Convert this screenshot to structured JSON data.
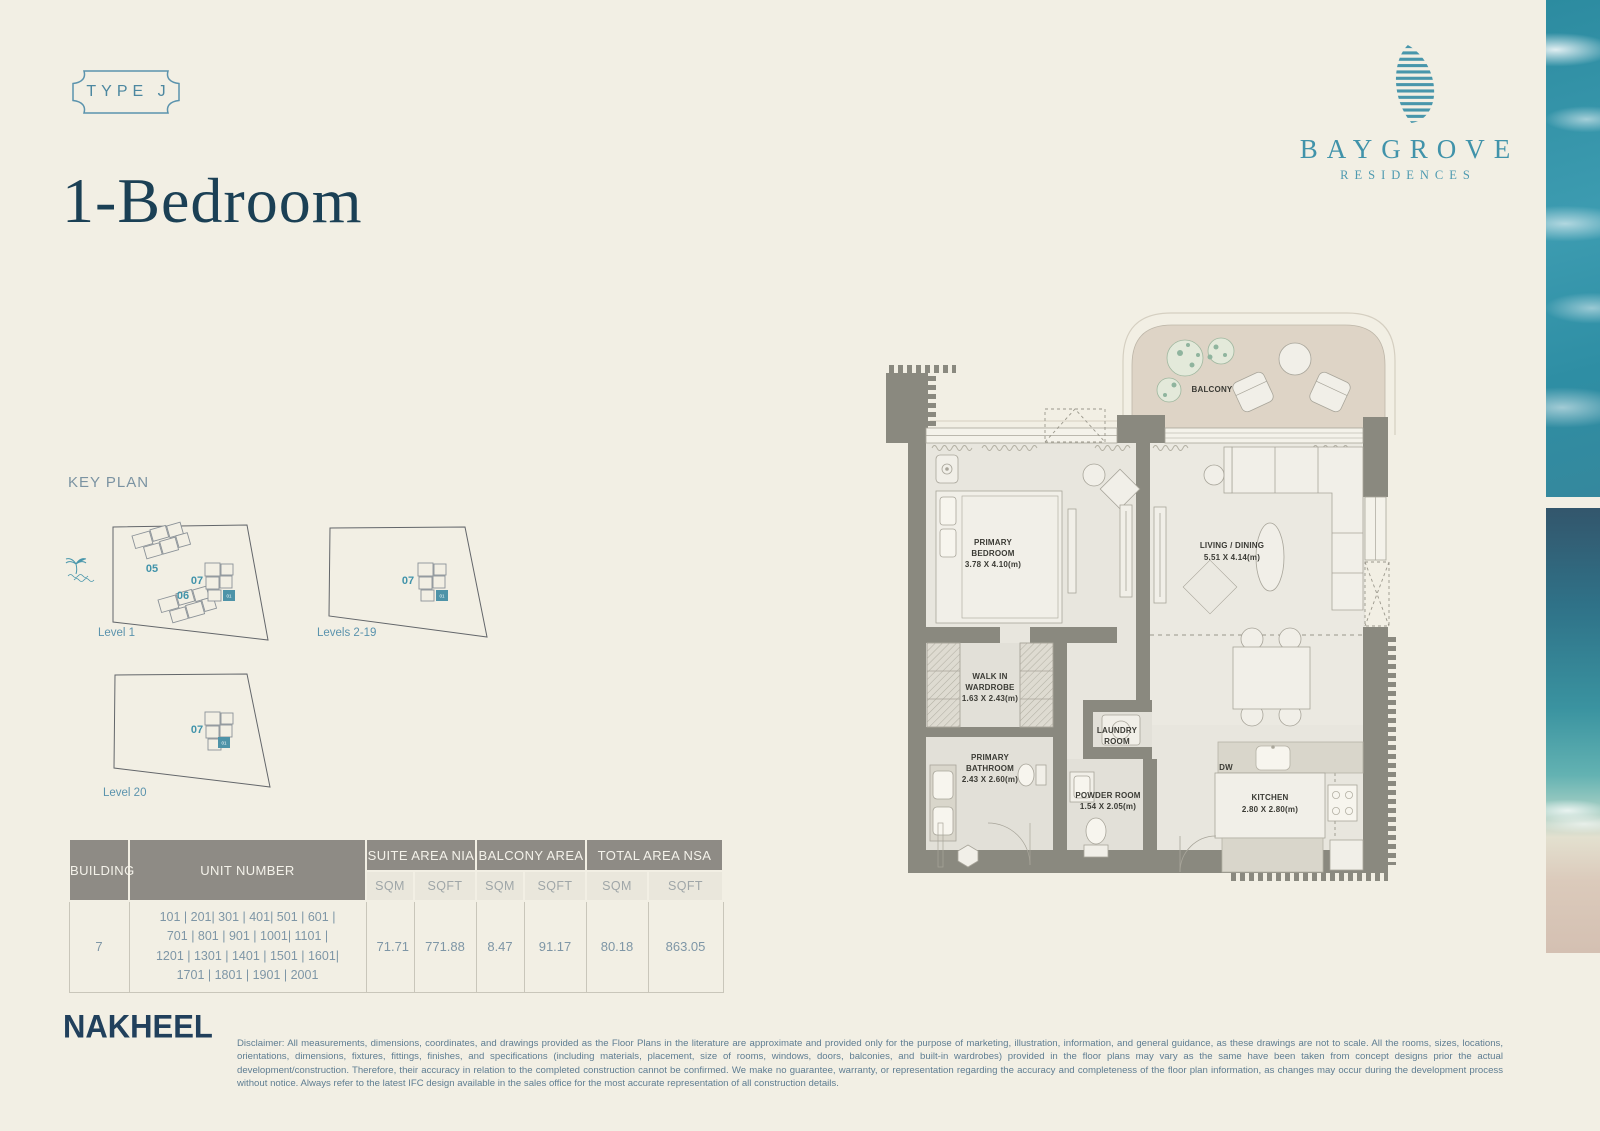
{
  "page": {
    "bg": "#f2efe4"
  },
  "badge": {
    "label": "TYPE J"
  },
  "header": {
    "title": "1-Bedroom"
  },
  "logo": {
    "brand": "BAYGROVE",
    "sub": "RESIDENCES"
  },
  "colors": {
    "teal": "#4193aa",
    "navy": "#1b4055",
    "table_header": "#8e8b85",
    "wall": "#8a897f",
    "highlight": "#4e93a8",
    "balcony_fill": "#ded4c6"
  },
  "key_plan": {
    "heading": "KEY PLAN",
    "plans": [
      {
        "caption": "Level 1",
        "building_labels": [
          "05",
          "06",
          "07"
        ],
        "highlight_unit": "01"
      },
      {
        "caption": "Levels 2-19",
        "building_labels": [
          "07"
        ],
        "highlight_unit": "01"
      },
      {
        "caption": "Level 20",
        "building_labels": [
          "07"
        ],
        "highlight_unit": "01"
      }
    ]
  },
  "floor_plan": {
    "balcony": {
      "name": "BALCONY"
    },
    "primary_bedroom": {
      "line1": "PRIMARY",
      "line2": "BEDROOM",
      "dims": "3.78 X 4.10(m)"
    },
    "living_dining": {
      "line1": "LIVING / DINING",
      "dims": "5.51 X 4.14(m)"
    },
    "walk_in_wardrobe": {
      "line1": "WALK IN",
      "line2": "WARDROBE",
      "dims": "1.63 X 2.43(m)"
    },
    "laundry": {
      "line1": "LAUNDRY",
      "line2": "ROOM"
    },
    "primary_bathroom": {
      "line1": "PRIMARY",
      "line2": "BATHROOM",
      "dims": "2.43 X 2.60(m)"
    },
    "powder_room": {
      "line1": "POWDER ROOM",
      "dims": "1.54 X 2.05(m)"
    },
    "kitchen": {
      "line1": "KITCHEN",
      "dims": "2.80 X 2.80(m)"
    },
    "dw_label": "DW"
  },
  "table": {
    "building_header": "BUILDING",
    "unit_header": "UNIT NUMBER",
    "groups": [
      "SUITE AREA NIA",
      "BALCONY AREA",
      "TOTAL AREA NSA"
    ],
    "sub_headers": [
      "SQM",
      "SQFT",
      "SQM",
      "SQFT",
      "SQM",
      "SQFT"
    ],
    "row": {
      "building": "7",
      "units": "101 | 201| 301 | 401| 501 | 601 | 701 | 801 | 901 | 1001| 1101 | 1201 | 1301 | 1401 | 1501 | 1601| 1701 | 1801 | 1901 | 2001",
      "values": [
        "71.71",
        "771.88",
        "8.47",
        "91.17",
        "80.18",
        "863.05"
      ]
    }
  },
  "footer": {
    "brand": "NAKHEEL",
    "disclaimer": "Disclaimer: All measurements, dimensions, coordinates, and drawings provided as the Floor Plans in the literature are approximate and provided only for the purpose of marketing, illustration, information, and general guidance, as these drawings are not to scale. All the rooms, sizes, locations, orientations, dimensions, fixtures, fittings, finishes, and specifications (including materials, placement, size of rooms, windows, doors, balconies, and built-in wardrobes) provided in the floor plans may vary as the same have been taken from concept designs prior the actual development/construction. Therefore, their accuracy in relation to the completed construction cannot be confirmed. We make no guarantee, warranty, or representation regarding the accuracy and completeness of the floor plan information, as changes may occur during the development process without notice. Always refer to the latest IFC design available in the sales office for the most accurate representation of all construction details."
  }
}
